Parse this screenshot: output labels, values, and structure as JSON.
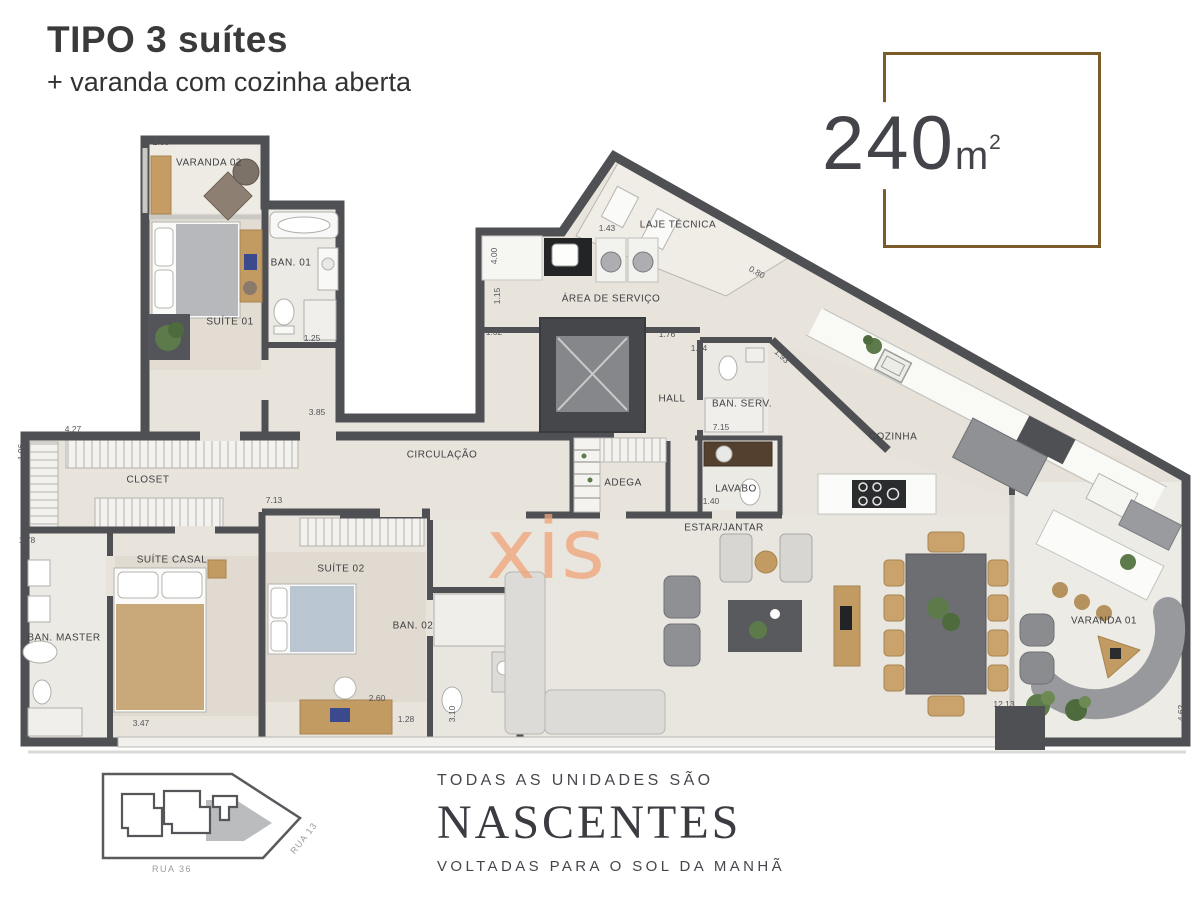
{
  "header": {
    "title": "TIPO 3 suítes",
    "subtitle": "+ varanda com cozinha aberta"
  },
  "area_badge": {
    "value": "240",
    "unit": "m",
    "sup": "2",
    "border_color": "#7b5c28",
    "text_color": "#42444a"
  },
  "plan": {
    "watermark": {
      "text": "xis",
      "color": "#f0a478"
    },
    "wall_color": "#4f5054",
    "floor_color": "#e8e4dc",
    "room_labels": [
      {
        "text": "VARANDA 02",
        "x": 209,
        "y": 163,
        "rot": 0
      },
      {
        "text": "BAN. 01",
        "x": 291,
        "y": 263,
        "rot": 0
      },
      {
        "text": "SUÍTE 01",
        "x": 230,
        "y": 322,
        "rot": 0
      },
      {
        "text": "LAJE TÉCNICA",
        "x": 678,
        "y": 225,
        "rot": 0
      },
      {
        "text": "ÁREA DE SERVIÇO",
        "x": 611,
        "y": 299,
        "rot": 0
      },
      {
        "text": "HALL",
        "x": 672,
        "y": 399,
        "rot": 0
      },
      {
        "text": "BAN. SERV.",
        "x": 742,
        "y": 404,
        "rot": 0
      },
      {
        "text": "CIRCULAÇÃO",
        "x": 442,
        "y": 455,
        "rot": 0
      },
      {
        "text": "ADEGA",
        "x": 623,
        "y": 483,
        "rot": 0
      },
      {
        "text": "LAVABO",
        "x": 736,
        "y": 489,
        "rot": 0
      },
      {
        "text": "COZINHA",
        "x": 893,
        "y": 437,
        "rot": 0
      },
      {
        "text": "CLOSET",
        "x": 148,
        "y": 480,
        "rot": 0
      },
      {
        "text": "SUÍTE CASAL",
        "x": 172,
        "y": 560,
        "rot": 0
      },
      {
        "text": "BAN. MASTER",
        "x": 64,
        "y": 638,
        "rot": 0
      },
      {
        "text": "SUÍTE 02",
        "x": 341,
        "y": 569,
        "rot": 0
      },
      {
        "text": "BAN. 02",
        "x": 413,
        "y": 626,
        "rot": 0
      },
      {
        "text": "ESTAR/JANTAR",
        "x": 724,
        "y": 528,
        "rot": 0
      },
      {
        "text": "VARANDA 01",
        "x": 1104,
        "y": 621,
        "rot": 0
      }
    ],
    "dimensions": [
      {
        "text": "2.35",
        "x": 161,
        "y": 142,
        "rot": 0
      },
      {
        "text": "4.23",
        "x": 597,
        "y": 180,
        "rot": -56
      },
      {
        "text": "1.43",
        "x": 607,
        "y": 228,
        "rot": 0
      },
      {
        "text": "4.00",
        "x": 494,
        "y": 256,
        "rot": -90
      },
      {
        "text": "1.15",
        "x": 497,
        "y": 296,
        "rot": -90
      },
      {
        "text": "1.02",
        "x": 494,
        "y": 332,
        "rot": 0
      },
      {
        "text": "1.76",
        "x": 667,
        "y": 334,
        "rot": 0
      },
      {
        "text": "0.80",
        "x": 757,
        "y": 272,
        "rot": 29
      },
      {
        "text": "1.14",
        "x": 699,
        "y": 348,
        "rot": 0
      },
      {
        "text": "1.93",
        "x": 782,
        "y": 356,
        "rot": 43
      },
      {
        "text": "7.15",
        "x": 721,
        "y": 427,
        "rot": 0
      },
      {
        "text": "1.40",
        "x": 711,
        "y": 501,
        "rot": 0
      },
      {
        "text": "3.85",
        "x": 317,
        "y": 412,
        "rot": 0
      },
      {
        "text": "1.25",
        "x": 312,
        "y": 338,
        "rot": 0
      },
      {
        "text": "4.27",
        "x": 73,
        "y": 429,
        "rot": 0
      },
      {
        "text": "1.96",
        "x": 21,
        "y": 452,
        "rot": -90
      },
      {
        "text": "1.78",
        "x": 27,
        "y": 540,
        "rot": 0
      },
      {
        "text": "7.13",
        "x": 274,
        "y": 500,
        "rot": 0
      },
      {
        "text": "4.17",
        "x": 274,
        "y": 512,
        "rot": 0
      },
      {
        "text": "3.47",
        "x": 141,
        "y": 723,
        "rot": 0
      },
      {
        "text": "2.60",
        "x": 377,
        "y": 698,
        "rot": 0
      },
      {
        "text": "1.28",
        "x": 406,
        "y": 719,
        "rot": 0
      },
      {
        "text": "3.10",
        "x": 452,
        "y": 714,
        "rot": -90
      },
      {
        "text": "12.13",
        "x": 1004,
        "y": 704,
        "rot": 0
      },
      {
        "text": "4.62",
        "x": 1181,
        "y": 713,
        "rot": -90
      }
    ]
  },
  "site_plan": {
    "rua36": "RUA 36",
    "rua13": "RUA 13"
  },
  "footer": {
    "line1": "TODAS AS UNIDADES SÃO",
    "brand": "NASCENTES",
    "line2": "VOLTADAS PARA O SOL DA MANHÃ"
  }
}
